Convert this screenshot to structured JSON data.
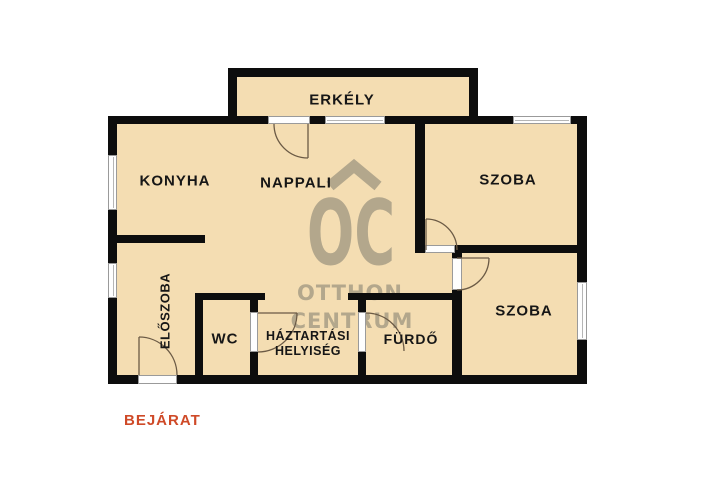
{
  "rooms": {
    "erkely": "ERKÉLY",
    "konyha": "KONYHA",
    "nappali": "NAPPALI",
    "szoba_felso": "SZOBA",
    "szoba_also": "SZOBA",
    "eloszoba": "ELŐSZOBA",
    "wc": "WC",
    "haztartasi_line1": "HÁZTARTÁSI",
    "haztartasi_line2": "HELYISÉG",
    "furdo": "FÜRDŐ"
  },
  "entrance_label": "BEJÁRAT",
  "watermark": {
    "logo": "OC",
    "name_line1": "OTTHON",
    "name_line2": "CENTRUM"
  },
  "colors": {
    "floor": "#f4ddb2",
    "wall": "#0d0d0d",
    "watermark": "#b3a78c",
    "entrance_text": "#cf4a28",
    "label_text": "#161616"
  }
}
